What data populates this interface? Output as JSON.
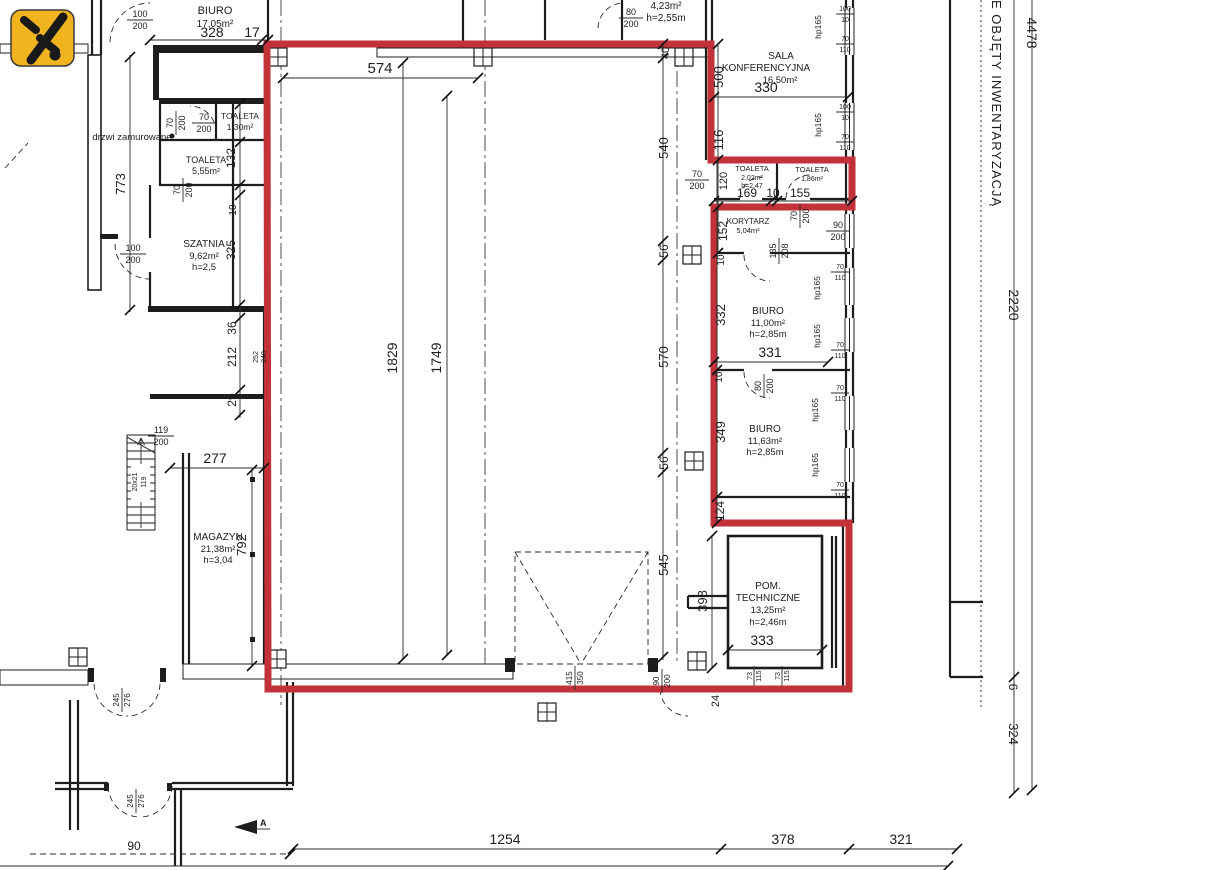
{
  "note_right": "E OBJĘTY INWENTARYZACJĄ",
  "marker_a": "A",
  "annotations": {
    "bricked_door": "drzwi zamurowane",
    "stairs_steps": "20x21",
    "stairs_width": "119"
  },
  "rooms": {
    "biuro17": {
      "name": "BIURO",
      "area": "17,05m²"
    },
    "toaleta130": {
      "name": "TOALETA",
      "area": "1,30m²"
    },
    "toaleta555": {
      "name": "TOALETA",
      "area": "5,55m²"
    },
    "szatnia": {
      "name": "SZATNIA",
      "area": "9,62m²",
      "h": "h=2,5"
    },
    "magazyn": {
      "name": "MAGAZYN",
      "area": "21,38m²",
      "h": "h=3,04"
    },
    "sala": {
      "line1": "SALA",
      "line2": "KONFERENCYJNA",
      "area": "16,50m²"
    },
    "toaleta202": {
      "name": "TOALETA",
      "area": "2,02m²",
      "h": "h=2,47"
    },
    "toaleta186": {
      "name": "TOALETA",
      "area": "1,86m²"
    },
    "korytarz": {
      "name": "KORYTARZ",
      "area": "5,04m²"
    },
    "biuro1100": {
      "name": "BIURO",
      "area": "11,00m²",
      "h": "h=2,85m"
    },
    "biuro1163": {
      "name": "BIURO",
      "area": "11,63m²",
      "h": "h=2,85m"
    },
    "pomtech": {
      "line1": "POM.",
      "line2": "TECHNICZNE",
      "area": "13,25m²",
      "h": "h=2,46m"
    },
    "room423": {
      "area": "4,23m²",
      "h": "h=2,55m"
    }
  },
  "dims": {
    "d6": "6",
    "d10": "10",
    "d17": "17",
    "d24": "24",
    "d29": "29",
    "d36": "36",
    "d40": "40",
    "d56": "56",
    "d90": "90",
    "d116": "116",
    "d120": "120",
    "d124": "124",
    "d132": "132",
    "d152": "152",
    "d155": "155",
    "d169": "169",
    "d212": "212",
    "d248": "248",
    "d252": "252",
    "d277": "277",
    "d321": "321",
    "d324": "324",
    "d325": "325",
    "d328": "328",
    "d330": "330",
    "d331": "331",
    "d332": "332",
    "d333": "333",
    "d349": "349",
    "d378": "378",
    "d398": "398",
    "d500": "500",
    "d540": "540",
    "d545": "545",
    "d570": "570",
    "d574": "574",
    "d773": "773",
    "d792": "792",
    "d1254": "1254",
    "d1749": "1749",
    "d1829": "1829",
    "d2220": "2220",
    "d4478": "4478",
    "hp": "hp165"
  },
  "fr": {
    "f100_200": {
      "n": "100",
      "d": "200"
    },
    "f70_200": {
      "n": "70",
      "d": "200"
    },
    "f80_200": {
      "n": "80",
      "d": "200"
    },
    "f90_200": {
      "n": "90",
      "d": "200"
    },
    "f119_200": {
      "n": "119",
      "d": "200"
    },
    "f135_208": {
      "n": "135",
      "d": "208"
    },
    "f245_276": {
      "n": "245",
      "d": "276"
    },
    "f415_350": {
      "n": "415",
      "d": "350"
    },
    "f73_115": {
      "n": "73",
      "d": "115"
    },
    "f100_10": {
      "n": "100",
      "d": "10"
    },
    "f70_110": {
      "n": "70",
      "d": "110"
    }
  }
}
